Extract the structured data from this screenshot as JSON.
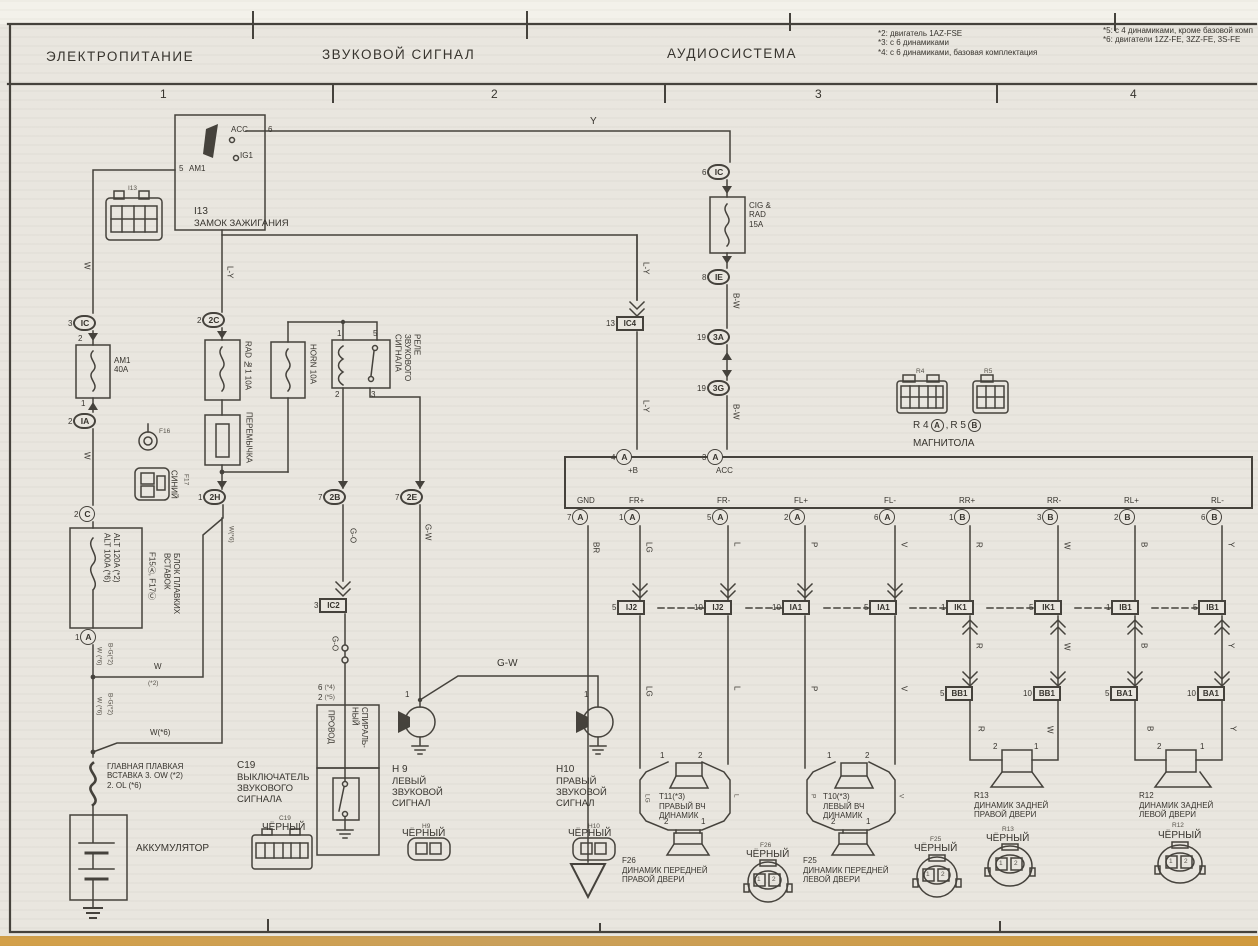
{
  "colors": {
    "paper": "#e9e6df",
    "paper_top": "#f3f1ea",
    "line": "#45423c",
    "ink": "#37342e",
    "edge": "#cf9a3f"
  },
  "header": {
    "title_power": "ЭЛЕКТРОПИТАНИЕ",
    "title_horn": "ЗВУКОВОЙ СИГНАЛ",
    "title_audio": "АУДИОСИСТЕМА",
    "notes_left": "*2: двигатель 1AZ-FSE\n*3: с 6 динамиками\n*4: с 6 динамиками, базовая комплектация",
    "notes_right": "*5: с 4 динамиками, кроме базовой комп\n*6: двигатели 1ZZ-FE, 3ZZ-FE, 3S-FE",
    "col1": "1",
    "col2": "2",
    "col3": "3",
    "col4": "4"
  },
  "ignition": {
    "tag": "I13",
    "pin5": "5",
    "am1": "AM1",
    "acc": "ACC",
    "pin6": "6",
    "ig1": "IG1",
    "id": "I13",
    "name": "ЗАМОК ЗАЖИГАНИЯ"
  },
  "wire": {
    "w": "W",
    "y": "Y",
    "ly": "L-Y",
    "bw": "B-W",
    "go": "G-O",
    "gw": "G-W",
    "br": "BR",
    "lg": "LG",
    "l": "L",
    "p": "P",
    "v": "V",
    "r": "R",
    "b": "B",
    "yy": "Y",
    "w2": "W",
    "n2": "(*2)",
    "w6": "W(*6)",
    "bg2": "B-G(*2)",
    "w6s": "W (*6)"
  },
  "power": {
    "ic_pin": "3",
    "ic": "IC",
    "f2": "2",
    "f1": "1",
    "fuse_am1": "AM1\n40A",
    "ia_pin": "2",
    "ia": "IA",
    "c_pin": "2",
    "c": "C",
    "alt": "ALT 120A (*2)\nALT 100A (*6)",
    "flb_f": "F15Ⓐ,  F17Ⓒ",
    "flb": "БЛОК ПЛАВКИХ\nВСТАВОК",
    "f16": "F16",
    "f17": "F17",
    "blue": "СИНИЙ",
    "a_pin": "1",
    "a": "A",
    "main_link": "ГЛАВНАЯ ПЛАВКАЯ\nВСТАВКА 3. OW (*2)\n2. OL (*6)",
    "battery": "АККУМУЛЯТОР"
  },
  "horn": {
    "c2c_pin": "2",
    "c2c": "2C",
    "fuse_rad": "RAD №1 10A",
    "jumper": "ПЕРЕМЫЧКА",
    "c2h_pin": "1",
    "c2h": "2H",
    "fuse_horn": "HORN 10A",
    "relay_p1": "1",
    "relay_p5": "5",
    "relay_p2": "2",
    "relay_p3": "3",
    "relay_name": "РЕЛЕ\nЗВУКОВОГО\nСИГНАЛА",
    "c2b_pin": "7",
    "c2b": "2B",
    "c2e_pin": "7",
    "c2e": "2E",
    "ic2_pin": "3",
    "ic2": "IC2",
    "sw_pin6": "6",
    "sw_n4": "(*4)",
    "sw_pin2": "2",
    "sw_n5": "(*5)",
    "spiral_r": "СПИРАЛЬ-\nНЫЙ",
    "spiral_l": "ПРОВОД",
    "c19_id": "C19",
    "c19_name": "ВЫКЛЮЧАТЕЛЬ\nЗВУКОВОГО\nСИГНАЛА",
    "c19_tag": "C19",
    "c19_conn": "ЧЁРНЫЙ",
    "h9_pin": "1",
    "h9_id": "H 9",
    "h9_name": "ЛЕВЫЙ\nЗВУКОВОЙ\nСИГНАЛ",
    "h9_tag": "H9",
    "h9_conn": "ЧЁРНЫЙ",
    "h10_pin": "1",
    "h10_id": "H10",
    "h10_name": "ПРАВЫЙ\nЗВУКОВОЙ\nСИГНАЛ",
    "h10_tag": "H10",
    "h10_conn": "ЧЁРНЫЙ"
  },
  "audio": {
    "ic_pin": "6",
    "ic": "IC",
    "fuse_cig": "CIG &\nRAD\n15A",
    "ie_pin": "8",
    "ie": "IE",
    "c3a_pin": "19",
    "c3a": "3A",
    "c3g_pin": "19",
    "c3g": "3G",
    "ic4_pin": "13",
    "ic4": "IC4",
    "unit_name": "МАГНИТОЛА",
    "r4": "R 4",
    "r4c": "A",
    "comma": ",",
    "r5": "R 5",
    "r5c": "B",
    "r4_tag": "R4",
    "r5_tag": "R5",
    "tb_pin": "4",
    "tb": "A",
    "tb_label": "+B",
    "ta_pin": "3",
    "ta": "A",
    "ta_label": "ACC",
    "terms": [
      {
        "label": "GND",
        "pin": "7",
        "t": "A"
      },
      {
        "label": "FR+",
        "pin": "1",
        "t": "A"
      },
      {
        "label": "FR-",
        "pin": "5",
        "t": "A"
      },
      {
        "label": "FL+",
        "pin": "2",
        "t": "A"
      },
      {
        "label": "FL-",
        "pin": "6",
        "t": "A"
      },
      {
        "label": "RR+",
        "pin": "1",
        "t": "B"
      },
      {
        "label": "RR-",
        "pin": "3",
        "t": "B"
      },
      {
        "label": "RL+",
        "pin": "2",
        "t": "B"
      },
      {
        "label": "RL-",
        "pin": "6",
        "t": "B"
      }
    ],
    "jf": [
      {
        "pin": "5",
        "t": "IJ2"
      },
      {
        "pin": "10",
        "t": "IJ2"
      },
      {
        "pin": "10",
        "t": "IA1"
      },
      {
        "pin": "5",
        "t": "IA1"
      }
    ],
    "jr": [
      {
        "pin": "1",
        "t": "IK1"
      },
      {
        "pin": "5",
        "t": "IK1"
      },
      {
        "pin": "1",
        "t": "IB1"
      },
      {
        "pin": "5",
        "t": "IB1"
      }
    ],
    "jb": [
      {
        "pin": "5",
        "t": "BB1"
      },
      {
        "pin": "10",
        "t": "BB1"
      },
      {
        "pin": "5",
        "t": "BA1"
      },
      {
        "pin": "10",
        "t": "BA1"
      }
    ],
    "p1": "1",
    "p2": "2",
    "t11_id": "T11(*3)",
    "t11_name": "ПРАВЫЙ ВЧ\nДИНАМИК",
    "t10_id": "T10(*3)",
    "t10_name": "ЛЕВЫЙ ВЧ\nДИНАМИК",
    "f26_id": "F26",
    "f26_name": "ДИНАМИК ПЕРЕДНЕЙ\nПРАВОЙ ДВЕРИ",
    "f26_tag": "F26",
    "f26_conn": "ЧЁРНЫЙ",
    "f25_id": "F25",
    "f25_name": "ДИНАМИК ПЕРЕДНЕЙ\nЛЕВОЙ ДВЕРИ",
    "f25_tag": "F25",
    "f25_conn": "ЧЁРНЫЙ",
    "r13_id": "R13",
    "r13_name": "ДИНАМИК ЗАДНЕЙ\nПРАВОЙ ДВЕРИ",
    "r13_tag": "R13",
    "r13_conn": "ЧЁРНЫЙ",
    "r12_id": "R12",
    "r12_name": "ДИНАМИК ЗАДНЕЙ\nЛЕВОЙ ДВЕРИ",
    "r12_tag": "R12",
    "r12_conn": "ЧЁРНЫЙ"
  }
}
